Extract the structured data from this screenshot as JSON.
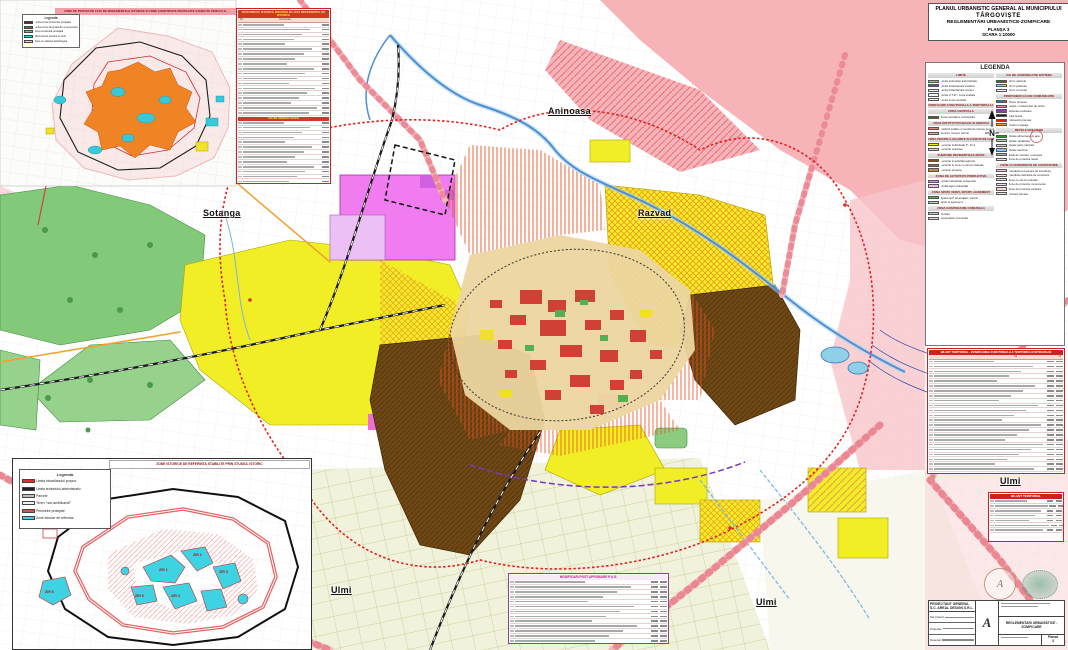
{
  "header": {
    "line1": "PLANUL URBANISTIC GENERAL AL MUNICIPIULUI",
    "line2": "TÂRGOVIȘTE",
    "line3": "REGLEMENTĂRI URBANISTICE-ZONIFICARE",
    "line4": "PLANȘA 3",
    "line5": "SCARA 1:10000"
  },
  "compass": {
    "label": "N"
  },
  "legend": {
    "title": "LEGENDA",
    "left_sections": [
      {
        "header": "LIMITE",
        "items": [
          {
            "c": "#f0a030",
            "l": "Limita teritoriului administrativ"
          },
          {
            "c": "#b43c28",
            "l": "Limita intravilanului existent"
          },
          {
            "c": "#dff0f0",
            "l": "Limita intravilanului propus"
          },
          {
            "c": "#eaf6f6",
            "l": "Limita U.T.R. / zona studiata"
          },
          {
            "c": "#f4fafa",
            "l": "Limita zonei centrale"
          }
        ]
      },
      {
        "header": "ZONIFICARE FUNCTIONALA A TERITORIULUI INTRAVILAN",
        "items": []
      },
      {
        "header": "ZONA CENTRALA",
        "items": [
          {
            "c": "#e02020",
            "l": "Zona centrala a municipiului"
          }
        ]
      },
      {
        "header": "ZONA INSTITUTII PUBLICE SI SERVICII",
        "items": [
          {
            "c": "#f08078",
            "l": "Institutii publice si servicii de interes general"
          },
          {
            "c": "#f4a8a0",
            "l": "Servicii, comert, birouri"
          }
        ]
      },
      {
        "header": "ZONA PENTRU LOCUINTE SI FUNCTIUNI COMPLEMENTARE",
        "items": [
          {
            "c": "#f8f000",
            "l": "Locuinte individuale P - P+2"
          },
          {
            "c": "#f0e070",
            "l": "Locuinte colective"
          }
        ]
      },
      {
        "header": "SUBZONE REZIDENTIALE MIXTE",
        "items": [
          {
            "c": "#8a5016",
            "l": "Locuinte si activitati agricole"
          },
          {
            "c": "#a46a2a",
            "l": "Locuinte in zone cu riscuri naturale"
          },
          {
            "c": "#c08a46",
            "l": "Locuinte propuse"
          }
        ]
      },
      {
        "header": "ZONA DE ACTIVITATI PRODUCTIVE",
        "items": [
          {
            "c": "#ee82ee",
            "l": "Unitati industriale si depozite"
          },
          {
            "c": "#f4b8f4",
            "l": "Unitati agro-industriale"
          }
        ]
      },
      {
        "header": "ZONA SPATII VERZI, SPORT, AGREMENT",
        "items": [
          {
            "c": "#58b858",
            "l": "Spatii verzi amenajate, parcuri"
          },
          {
            "c": "#a8e0a8",
            "l": "Sport si agrement"
          }
        ]
      },
      {
        "header": "ZONA GOSPODARIE COMUNALA",
        "items": [
          {
            "c": "#c8c8c8",
            "l": "Cimitire"
          },
          {
            "c": "#e0e0e0",
            "l": "Gospodarie comunala"
          }
        ]
      }
    ],
    "right_sections": [
      {
        "header": "CAI DE COMUNICATIE RUTIERA",
        "items": [
          {
            "c": "#e02020",
            "l": "Drum national"
          },
          {
            "c": "#f8d800",
            "l": "Drum judetean"
          },
          {
            "c": "#ffffff",
            "l": "Drum comunal"
          }
        ]
      },
      {
        "header": "PROPUNERI CAI DE COMUNICATIE",
        "items": [
          {
            "c": "#e020e0",
            "l": "Artere propuse"
          },
          {
            "c": "#f080c0",
            "l": "Largiri / modernizari de strazi"
          },
          {
            "c": "#9830d0",
            "l": "Varianta ocolitoare"
          },
          {
            "c": "#202020",
            "l": "Cale ferata"
          },
          {
            "c": "#e02020",
            "l": "Intersectii propuse"
          },
          {
            "c": "#f0a030",
            "l": "Poduri si pasaje"
          }
        ]
      },
      {
        "header": "RETELE EDILITARE",
        "items": [
          {
            "c": "#20a020",
            "l": "Retele alimentare cu apa"
          },
          {
            "c": "#a0e0a0",
            "l": "Retele canalizare"
          },
          {
            "c": "#f8f000",
            "l": "Retele gaze naturale"
          },
          {
            "c": "#80d0d0",
            "l": "Retele electrice"
          },
          {
            "c": "#b0b0b0",
            "l": "Statii de epurare / pompare"
          },
          {
            "c": "#e8e8e8",
            "l": "Zone de protectie retele"
          }
        ]
      },
      {
        "header": "ZONE CU INTERDICTII DE CONSTRUIRE",
        "items": [
          {
            "c": "#f8d0d8",
            "h": 1,
            "l": "Interdictie temporara de construire"
          },
          {
            "c": "#f8e0e8",
            "h": 1,
            "l": "Interdictie definitiva de construire"
          },
          {
            "c": "#f0d8f0",
            "h": 1,
            "l": "Zone cu riscuri naturale"
          },
          {
            "c": "#e8e0f8",
            "h": 1,
            "l": "Zone de protectie monumente"
          },
          {
            "c": "#f8d8c8",
            "h": 1,
            "l": "Zone de protectie sanitara"
          },
          {
            "c": "#f0e8d8",
            "h": 1,
            "l": "Culoare tehnice"
          }
        ]
      }
    ]
  },
  "map_labels": {
    "towns": [
      {
        "label": "Aninoasa"
      },
      {
        "label": "Razvad"
      },
      {
        "label": "Sotanga"
      },
      {
        "label": "Ulmi"
      },
      {
        "label": "Ulmi"
      },
      {
        "label": "Ulmi"
      }
    ]
  },
  "inset_top": {
    "header": "ZONE DE PROTECTIE FATA DE MONUMENTELE ISTORICE SI ZONE CONSTRUITE PROTEJATE STABILITE PRIN P.U.G.",
    "legend_title": "Legenda",
    "items": [
      {
        "c": "#4a3020",
        "l": "Limita zonei construite protejate"
      },
      {
        "c": "#e03030",
        "l": "Limita zonei de protectie a monumentelor"
      },
      {
        "c": "#f080a0",
        "l": "Zona construita protejata"
      },
      {
        "c": "#40c8d8",
        "l": "Monumente istorice si situri"
      },
      {
        "c": "#f0e040",
        "l": "Zone cu valoare arheologica"
      }
    ]
  },
  "inset_bottom": {
    "header": "ZONE ISTORICE DE REFERINTA STABILITE PRIN STUDIUL ISTORIC",
    "legend_title": "Legenda",
    "items": [
      {
        "c": "#e03030",
        "l": "Limita intravilanului propus"
      },
      {
        "c": "#202020",
        "l": "Limita teritoriului administrativ"
      },
      {
        "c": "#c0c0c0",
        "l": "Parcele"
      },
      {
        "c": "#f8f0f0",
        "l": "Teren \"non-aedificandi\""
      },
      {
        "c": "#e05050",
        "l": "Perimetre protejate"
      },
      {
        "c": "#40d0e0",
        "l": "Zone istorice de referinta"
      }
    ],
    "zir_labels": [
      "ZIR 1",
      "ZIR 2",
      "ZIR 3",
      "ZIR 4",
      "ZIR 5",
      "ZIR 6"
    ]
  },
  "tables": {
    "monuments": {
      "title": "MONUMENTE ISTORICE INSCRISE IN LISTA MONUMENTELOR ISTORICE",
      "col_no": "Nr.",
      "col_label": "Denumire",
      "rows_a": 19,
      "section2": "SITURI ARHEOLOGICE",
      "rows_b": 13
    },
    "bilant": {
      "title": "BILANT TERITORIAL - ZONIFICAREA FUNCTIONALA A TERITORIULUI INTRAVILAN",
      "col1": "ha",
      "col2": "%",
      "rows": 24,
      "notes": 2
    },
    "ulmi": {
      "title": "BILANT TERITORIAL",
      "rows": 7
    },
    "modificari": {
      "title": "MODIFICARI POST APROBARE P.U.G.",
      "rows": 14,
      "footer_rows": 2
    }
  },
  "cartouche": {
    "company": "PROIECTANT GENERAL S.C. AREAL DESIGN S.R.L.",
    "logo": "A",
    "roles": [
      "Sef proiect",
      "Proiectat",
      "Desenat"
    ],
    "project": "REGLEMENTARI URBANISTICE - ZONIFICARE",
    "sheet_label": "Plansa",
    "sheet_no": "3"
  },
  "colors": {
    "accent_red": "#cc2222",
    "protection_pink": "#f5b2b8",
    "residential_yellow": "#f2ee26",
    "forest_green": "#82ca7a",
    "rural_brown": "#6f4815",
    "industrial_magenta": "#ee82ee",
    "historic_cyan": "#38c8d8",
    "river_blue": "#4d8fd1"
  }
}
